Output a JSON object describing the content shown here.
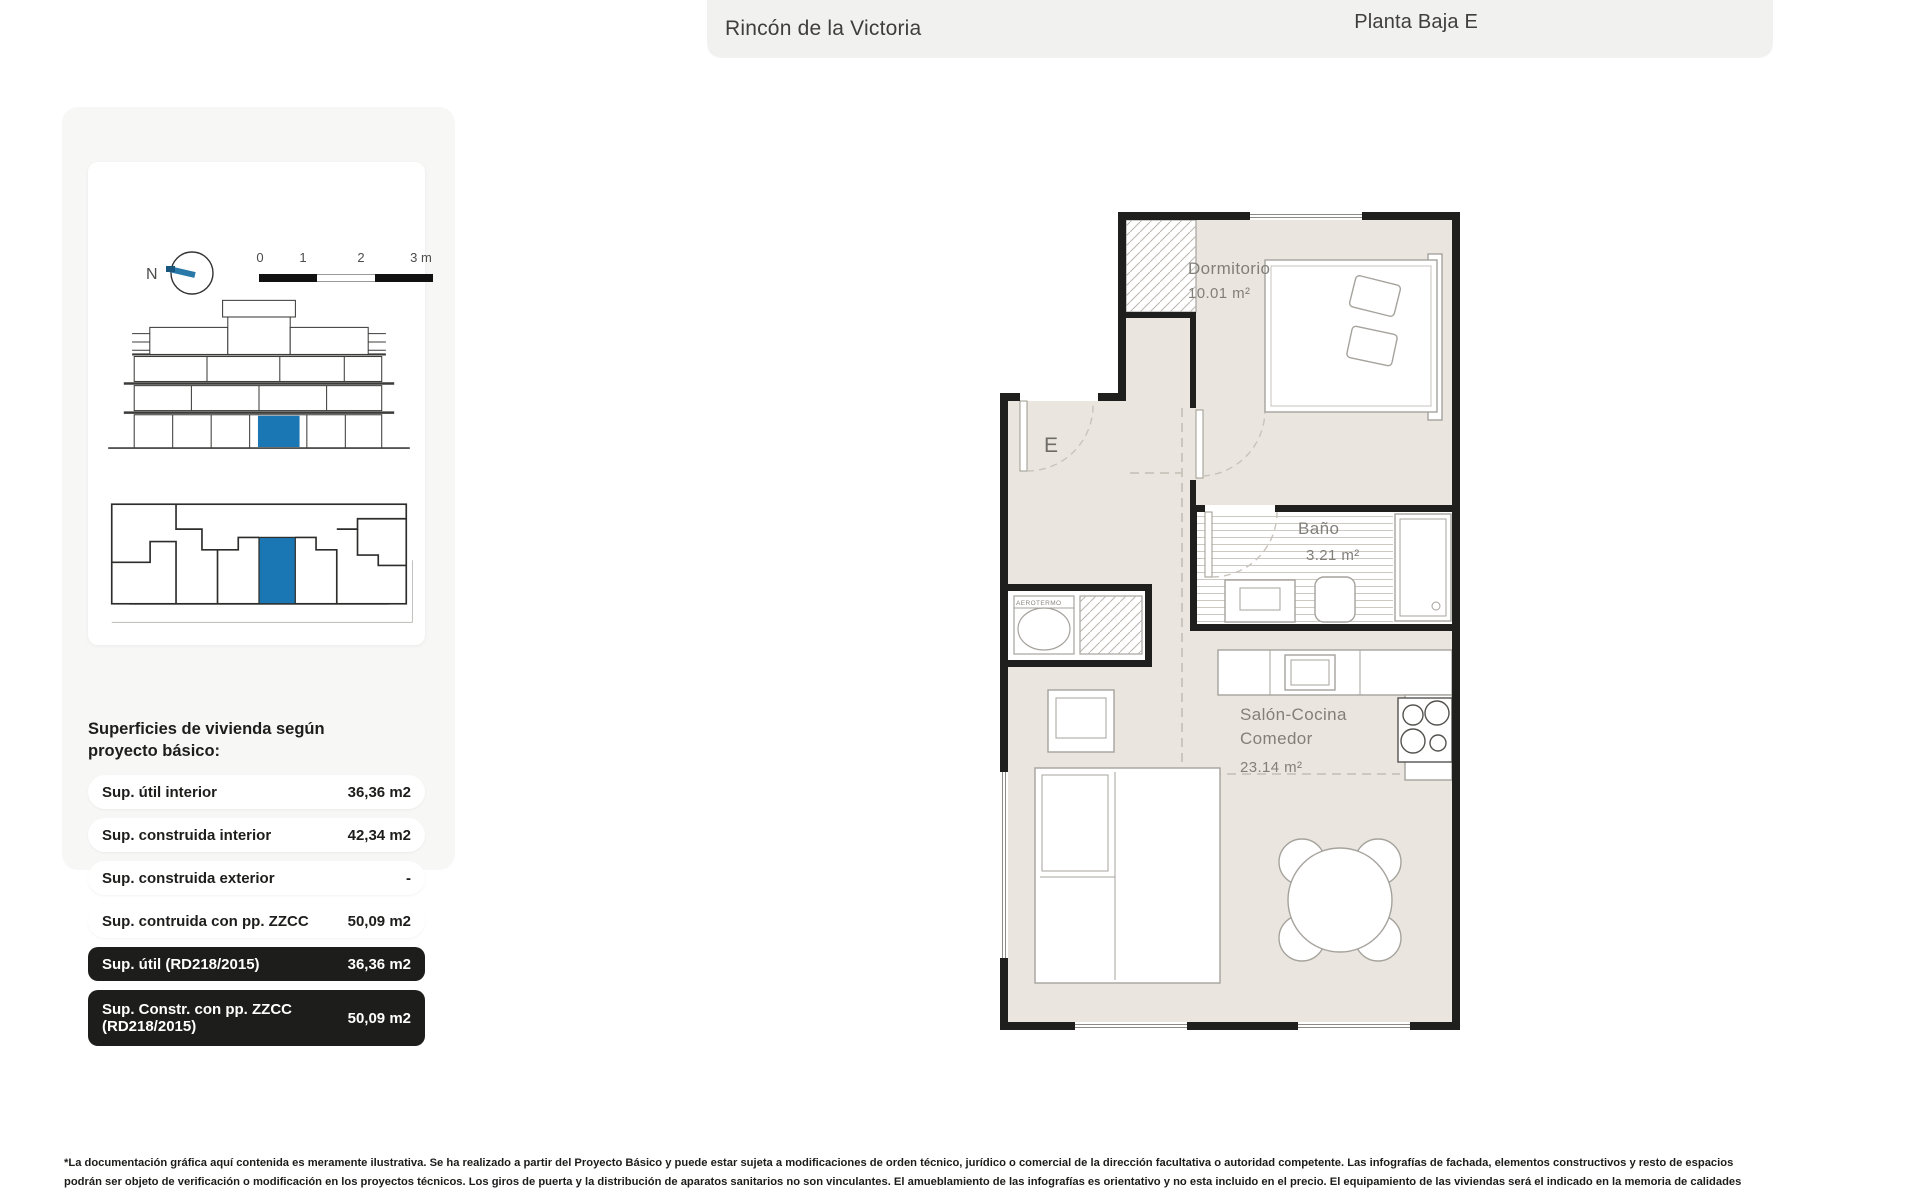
{
  "header": {
    "project_name": "Rincón de la Victoria",
    "plan_title": "Planta Baja E"
  },
  "sidebar": {
    "compass_label": "N",
    "scale_ticks": [
      "0",
      "1",
      "2",
      "3 m"
    ],
    "areas_title_line1": "Superficies de vivienda según",
    "areas_title_line2": "proyecto básico:",
    "rows": [
      {
        "label": "Sup. útil interior",
        "value": "36,36 m2"
      },
      {
        "label": "Sup. construida interior",
        "value": "42,34 m2"
      },
      {
        "label": "Sup. construida exterior",
        "value": "-"
      },
      {
        "label": "Sup. contruida con pp. ZZCC",
        "value": "50,09 m2"
      },
      {
        "label": "Sup. útil (RD218/2015)",
        "value": "36,36 m2"
      },
      {
        "label": "Sup. Constr. con pp. ZZCC (RD218/2015)",
        "value": "50,09 m2"
      }
    ]
  },
  "plan": {
    "entrance_label": "E",
    "aerotermo_label": "AEROTERMO",
    "rooms": [
      {
        "name": "Dormitorio",
        "area": "10.01 m²"
      },
      {
        "name": "Baño",
        "area": "3.21 m²"
      },
      {
        "name_line1": "Salón-Cocina",
        "name_line2": "Comedor",
        "area": "23.14 m²"
      }
    ]
  },
  "colors": {
    "highlight": "#1b77b4",
    "compass_needle": "#2878a8",
    "compass_tip": "#19567d"
  },
  "footer": {
    "line1": "*La documentación gráfica aquí contenida es meramente ilustrativa. Se ha realizado a partir del Proyecto Básico y puede estar sujeta a modificaciones de orden técnico, jurídico o comercial de la dirección facultativa o autoridad competente. Las infografías de fachada, elementos constructivos y resto de espacios",
    "line2": "podrán ser objeto de verificación o modificación en los proyectos técnicos. Los giros de puerta y la distribución de aparatos sanitarios no son vinculantes. El amueblamiento de las infografías es orientativo y no esta incluido en el precio. El equipamiento de las viviendas será el indicado en la memoria de calidades"
  }
}
